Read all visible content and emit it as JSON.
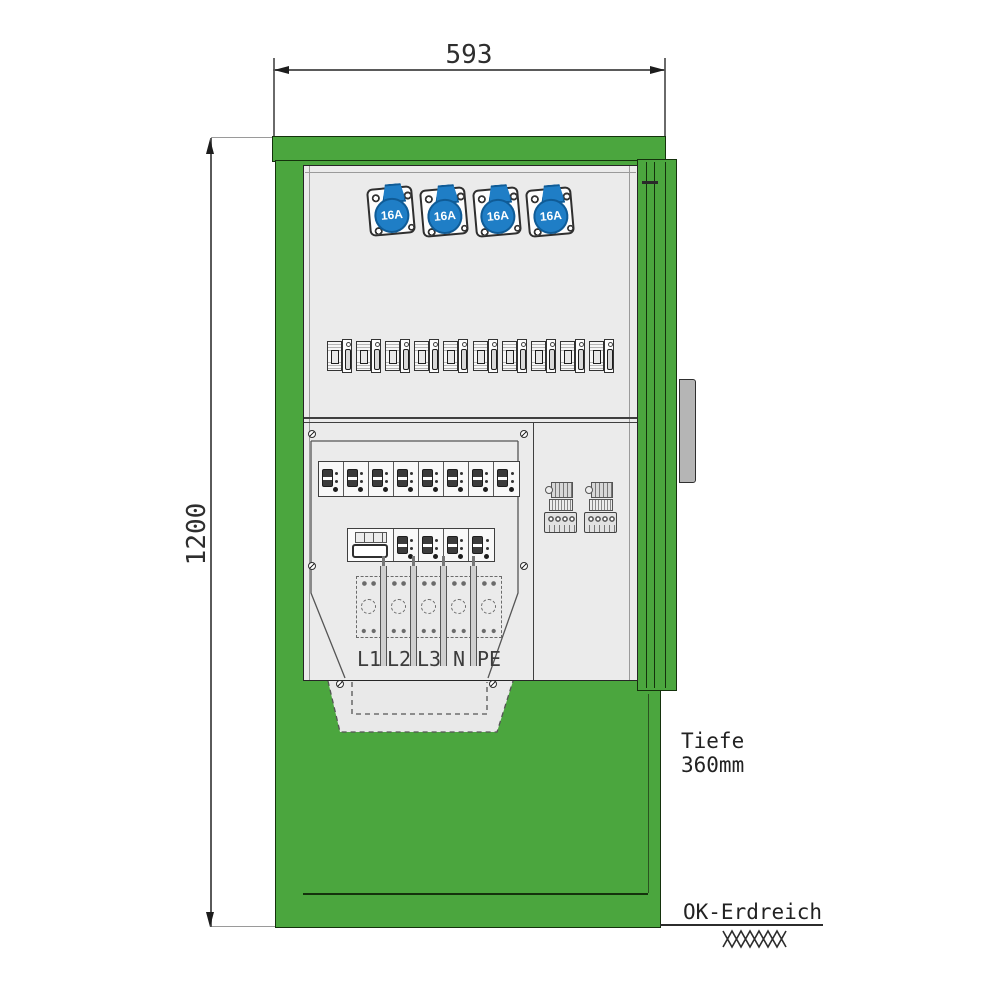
{
  "dimensions": {
    "width_mm": "593",
    "height_mm": "1200",
    "depth_label": "Tiefe",
    "depth_value": "360mm",
    "ground_label": "OK-Erdreich"
  },
  "sockets": [
    {
      "label": "16A"
    },
    {
      "label": "16A"
    },
    {
      "label": "16A"
    },
    {
      "label": "16A"
    }
  ],
  "terminal_labels": [
    "L1",
    "L2",
    "L3",
    "N",
    "PE"
  ],
  "counts": {
    "din_module_pairs": 10,
    "sub_breakers_row1": 8,
    "sub_breakers_row2": 4,
    "fuse_bases": 5
  },
  "colors": {
    "cabinet_green": "#4BA63E",
    "outline_dark": "#14320C",
    "panel_gray": "#EBEBEB",
    "socket_blue": "#1F7EC6",
    "socket_blue_dark": "#0F5B96",
    "dimension_line": "#5A5A5A"
  }
}
